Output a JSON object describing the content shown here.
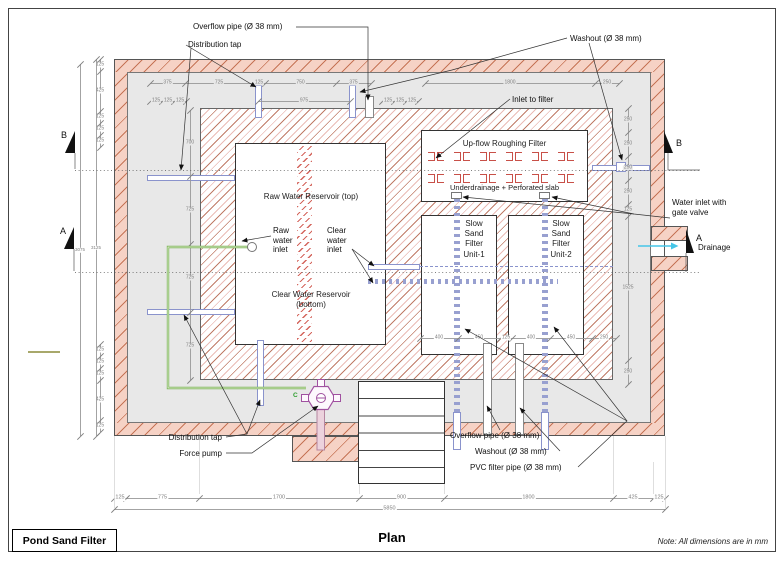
{
  "title_block": {
    "label": "Pond Sand Filter"
  },
  "caption": "Plan",
  "note": "Note: All dimensions are in mm",
  "pump_port_label": "C",
  "rooms": {
    "raw_reservoir": "Raw Water Reservoir (top)",
    "clear_reservoir": "Clear Water Reservoir\n(bottom)",
    "roughing": "Up-flow Roughing Filter",
    "underdrainage": "Underdrainage + Perforated slab",
    "ssf1": "Slow\nSand\nFilter\nUnit-1",
    "ssf2": "Slow\nSand\nFilter\nUnit-2"
  },
  "colors": {
    "wall_fill": "#f6d2c5",
    "wall_hatch": "#c06a4a",
    "inner_hatch_brown": "#96603c",
    "inner_hatch_red": "#c85048",
    "pipe_blue": "#8a93cc",
    "pipe_green": "#7db356",
    "pump_purple": "#a051a0",
    "drain_cyan": "#45c6e8",
    "interior_gray": "#e8e8e8"
  },
  "roughing_brackets": {
    "rows": 2,
    "pairs_per_row": 6
  },
  "stairs_steps": 6,
  "callouts": [
    {
      "name": "overflow-pipe-top",
      "text": "Overflow pipe (Ø 38 mm)",
      "x": 193,
      "y": 22,
      "align": "left",
      "leaders": [
        [
          [
            296,
            27
          ],
          [
            368,
            27
          ],
          [
            368,
            100
          ]
        ]
      ]
    },
    {
      "name": "distribution-tap-top",
      "text": "Distribution tap",
      "x": 188,
      "y": 40,
      "align": "left",
      "leaders": [
        [
          [
            186,
            45
          ],
          [
            256,
            87
          ]
        ],
        [
          [
            191,
            48
          ],
          [
            181,
            170
          ]
        ]
      ]
    },
    {
      "name": "washout-top",
      "text": "Washout (Ø 38 mm)",
      "x": 570,
      "y": 34,
      "align": "left",
      "leaders": [
        [
          [
            567,
            38
          ],
          [
            452,
            70
          ],
          [
            360,
            92
          ]
        ],
        [
          [
            589,
            43
          ],
          [
            622,
            160
          ]
        ]
      ]
    },
    {
      "name": "inlet-to-filter",
      "text": "Inlet to filter",
      "x": 512,
      "y": 95,
      "align": "left",
      "leaders": [
        [
          [
            510,
            99
          ],
          [
            436,
            158
          ]
        ]
      ]
    },
    {
      "name": "water-inlet-gate-valve",
      "text": "Water inlet with\ngate valve",
      "x": 672,
      "y": 198,
      "align": "left",
      "leaders": [
        [
          [
            670,
            218
          ],
          [
            634,
            214
          ],
          [
            552,
            197
          ]
        ],
        [
          [
            634,
            214
          ],
          [
            463,
            197
          ]
        ]
      ]
    },
    {
      "name": "drainage",
      "text": "Drainage",
      "x": 698,
      "y": 243,
      "align": "left",
      "leaders": []
    },
    {
      "name": "raw-water-inlet",
      "text": "Raw\nwater\ninlet",
      "x": 273,
      "y": 226,
      "align": "left",
      "leaders": [
        [
          [
            271,
            236
          ],
          [
            242,
            241
          ]
        ]
      ]
    },
    {
      "name": "clear-water-inlet",
      "text": "Clear\nwater\ninlet",
      "x": 327,
      "y": 226,
      "align": "left",
      "leaders": [
        [
          [
            352,
            249
          ],
          [
            374,
            266
          ]
        ],
        [
          [
            352,
            249
          ],
          [
            373,
            283
          ]
        ]
      ]
    },
    {
      "name": "distribution-tap-bottom",
      "text": "Distribution tap",
      "x": 222,
      "y": 433,
      "align": "right",
      "leaders": [
        [
          [
            226,
            437
          ],
          [
            247,
            434
          ],
          [
            260,
            400
          ]
        ],
        [
          [
            247,
            434
          ],
          [
            184,
            315
          ]
        ]
      ]
    },
    {
      "name": "force-pump",
      "text": "Force pump",
      "x": 222,
      "y": 449,
      "align": "right",
      "leaders": [
        [
          [
            226,
            453
          ],
          [
            252,
            453
          ],
          [
            318,
            406
          ]
        ]
      ]
    },
    {
      "name": "overflow-pipe-bottom",
      "text": "Overflow pipe (Ø 38 mm)",
      "x": 450,
      "y": 431,
      "align": "left",
      "leaders": [
        [
          [
            500,
            430
          ],
          [
            487,
            406
          ]
        ]
      ]
    },
    {
      "name": "washout-bottom",
      "text": "Washout (Ø 38 mm)",
      "x": 475,
      "y": 447,
      "align": "left",
      "leaders": [
        [
          [
            560,
            451
          ],
          [
            520,
            408
          ]
        ]
      ]
    },
    {
      "name": "pvc-filter-pipe",
      "text": "PVC filter pipe (Ø 38 mm)",
      "x": 470,
      "y": 463,
      "align": "left",
      "leaders": [
        [
          [
            578,
            467
          ],
          [
            627,
            421
          ],
          [
            554,
            327
          ]
        ],
        [
          [
            627,
            421
          ],
          [
            465,
            329
          ]
        ]
      ]
    }
  ],
  "section_markers": [
    {
      "letter": "B",
      "lx": 61,
      "ly": 130,
      "tri": "75,131 75,153 65,153",
      "stem": "75,153 75,169"
    },
    {
      "letter": "A",
      "lx": 60,
      "ly": 226,
      "tri": "74,227 74,249 64,249",
      "stem": "74,249 74,271"
    },
    {
      "letter": "B",
      "lx": 676,
      "ly": 138,
      "tri": "664,131 664,153 673,153",
      "stem": "668,153 668,170 700,170"
    },
    {
      "letter": "A",
      "lx": 696,
      "ly": 233,
      "tri": "686,229 686,253 694,253",
      "stem": "686,253 686,272"
    }
  ],
  "dim_chains": [
    {
      "name": "top-row-1a",
      "dir": "h",
      "y": 83,
      "bg": "#e8e8e8",
      "ticks": [
        150,
        185,
        253,
        265,
        336,
        371
      ],
      "labels": [
        "375",
        "725",
        "125",
        "750",
        "375"
      ]
    },
    {
      "name": "top-row-1b",
      "dir": "h",
      "y": 83,
      "bg": "#e8e8e8",
      "ticks": [
        425,
        595,
        619
      ],
      "labels": [
        "1800",
        "250"
      ]
    },
    {
      "name": "top-row-2a",
      "dir": "h",
      "y": 101,
      "bg": "#e8e8e8",
      "ticks": [
        150,
        162,
        174,
        186
      ],
      "labels": [
        "125",
        "125",
        "125"
      ]
    },
    {
      "name": "top-row-2b",
      "dir": "h",
      "y": 101,
      "bg": "#e8e8e8",
      "ticks": [
        258,
        350
      ],
      "labels": [
        "975"
      ]
    },
    {
      "name": "top-row-2c",
      "dir": "h",
      "y": 101,
      "bg": "#e8e8e8",
      "ticks": [
        382,
        394,
        406,
        418
      ],
      "labels": [
        "125",
        "125",
        "125"
      ]
    },
    {
      "name": "unit-row",
      "dir": "h",
      "y": 338,
      "bg": "#fff",
      "ticks": [
        420,
        458,
        500,
        512,
        550,
        592,
        616
      ],
      "labels": [
        "400",
        "450",
        "125",
        "400",
        "450",
        "250"
      ]
    },
    {
      "name": "bottom-main",
      "dir": "h",
      "y": 498,
      "bg": "#fff",
      "fs": 5.5,
      "ticks": [
        114,
        126,
        199,
        359,
        444,
        613,
        653,
        665
      ],
      "labels": [
        "125",
        "775",
        "1700",
        "900",
        "1800",
        "425",
        "125"
      ]
    },
    {
      "name": "bottom-total",
      "dir": "h",
      "y": 509,
      "bg": "#fff",
      "fs": 5.5,
      "ticks": [
        114,
        665
      ],
      "labels": [
        "5850"
      ]
    },
    {
      "name": "left-outer-top",
      "dir": "v",
      "x": 100,
      "bg": "#fff",
      "ticks": [
        59,
        71,
        111,
        123,
        135,
        147
      ],
      "labels": [
        "125",
        "425",
        "125",
        "125",
        "125"
      ]
    },
    {
      "name": "left-outer-bottom",
      "dir": "v",
      "x": 100,
      "bg": "#fff",
      "ticks": [
        344,
        356,
        368,
        380,
        420,
        432
      ],
      "labels": [
        "125",
        "125",
        "125",
        "425",
        "125"
      ]
    },
    {
      "name": "left-total-3075",
      "dir": "v",
      "x": 80,
      "bg": "#fff",
      "fs": 4.5,
      "ticks": [
        64,
        436
      ],
      "labels": [
        "3075"
      ]
    },
    {
      "name": "left-total-3125",
      "dir": "v",
      "x": 96,
      "bg": "#fff",
      "fs": 4.5,
      "ticks": [
        59,
        436
      ],
      "labels": [
        "3125"
      ]
    },
    {
      "name": "left-inner",
      "dir": "v",
      "x": 190,
      "bg": "#e8e8e8",
      "ticks": [
        110,
        176,
        244,
        312,
        380
      ],
      "labels": [
        "700",
        "725",
        "725",
        "725"
      ]
    },
    {
      "name": "right-chain",
      "dir": "v",
      "x": 628,
      "bg": "#e8e8e8",
      "ticks": [
        108,
        132,
        156,
        180,
        204,
        216,
        360,
        384
      ],
      "labels": [
        "250",
        "250",
        "250",
        "250",
        "125",
        "1525",
        "250"
      ]
    }
  ]
}
